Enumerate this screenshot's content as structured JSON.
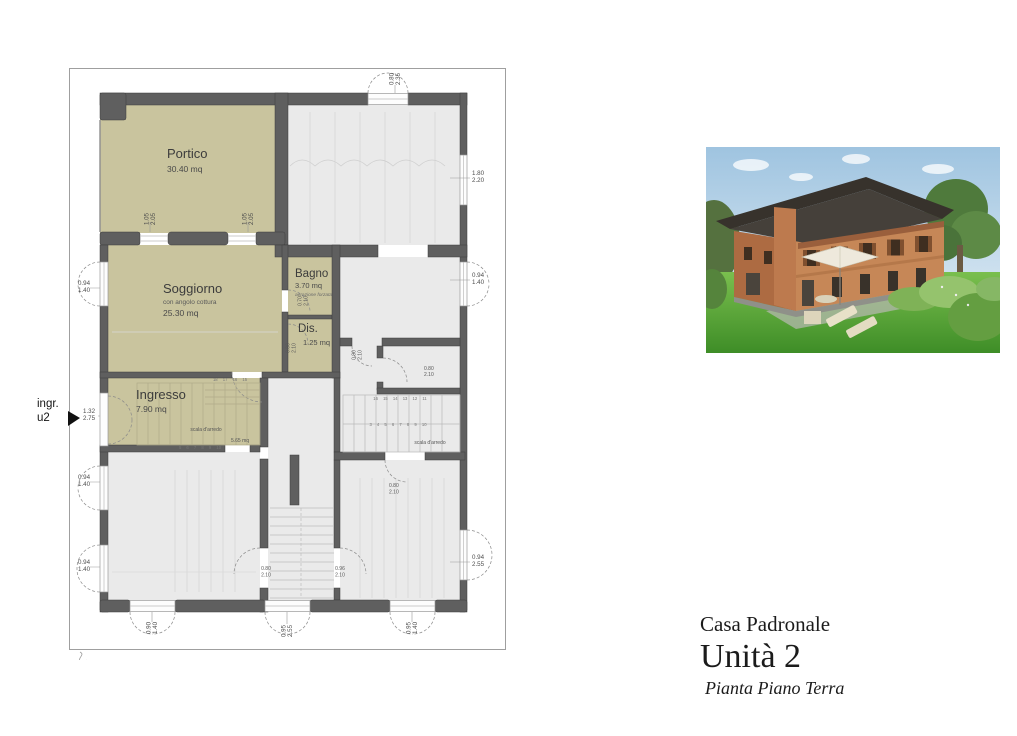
{
  "title_block": {
    "project": "Casa Padronale",
    "unit": "Unità 2",
    "plan": "Pianta Piano Terra"
  },
  "plan": {
    "entrance_label": {
      "line1": "ingr.",
      "line2": "u2"
    },
    "rooms": {
      "portico": {
        "name": "Portico",
        "area": "30.40 mq"
      },
      "soggiorno": {
        "name": "Soggiorno",
        "note": "con angolo cottura",
        "area": "25.30 mq"
      },
      "bagno": {
        "name": "Bagno",
        "area": "3.70 mq",
        "note": "aerazione forzata"
      },
      "dis": {
        "name": "Dis.",
        "area": "1.25 mq"
      },
      "ingresso": {
        "name": "Ingresso",
        "area": "7.90 mq"
      }
    },
    "stairs": {
      "left": {
        "label": "scala d'arredo",
        "area": "5.65 mq",
        "top_steps": "18 17 16 15",
        "bottom_steps": "5 6 7 8 9 10"
      },
      "right": {
        "label": "scala d'arredo",
        "top_steps": "16 15 14 13 12 11",
        "mid_steps": "3 4 5 6 7 8 9 10"
      }
    },
    "dims": {
      "top_door": [
        "0.80",
        "2.35"
      ],
      "portico_col_left": [
        "1.05",
        "2.05"
      ],
      "portico_col_right": [
        "1.05",
        "2.05"
      ],
      "right_top": [
        "1.80",
        "2.20"
      ],
      "right_mid": [
        "0.94",
        "1.40"
      ],
      "right_low": [
        "0.94",
        "2.55"
      ],
      "left_sogg": [
        "0.94",
        "1.40"
      ],
      "entrance": [
        "1.32",
        "2.75"
      ],
      "left_mid": [
        "0.94",
        "1.40"
      ],
      "left_low": [
        "0.94",
        "1.40"
      ],
      "bottom_left": [
        "0.90",
        "1.40"
      ],
      "bottom_center": [
        "0.95",
        "2.55"
      ],
      "bottom_right": [
        "0.95",
        "1.40"
      ],
      "door_bagno": [
        "0.70",
        "2.10"
      ],
      "door_dis": [
        "0.80",
        "2.10"
      ],
      "door_mid1": [
        "0.80",
        "2.10"
      ],
      "door_mid2": [
        "0.80",
        "2.10"
      ],
      "door_right": [
        "0.80",
        "2.10"
      ],
      "door_low_left": [
        "0.80",
        "2.10"
      ],
      "door_low_right": [
        "0.96",
        "2.10"
      ]
    },
    "colors": {
      "wall": "#5f5f5f",
      "covered_room_fill": "#c9c49e",
      "room_fill": "#eaeaea",
      "frame_line": "#9f9f9f"
    }
  }
}
